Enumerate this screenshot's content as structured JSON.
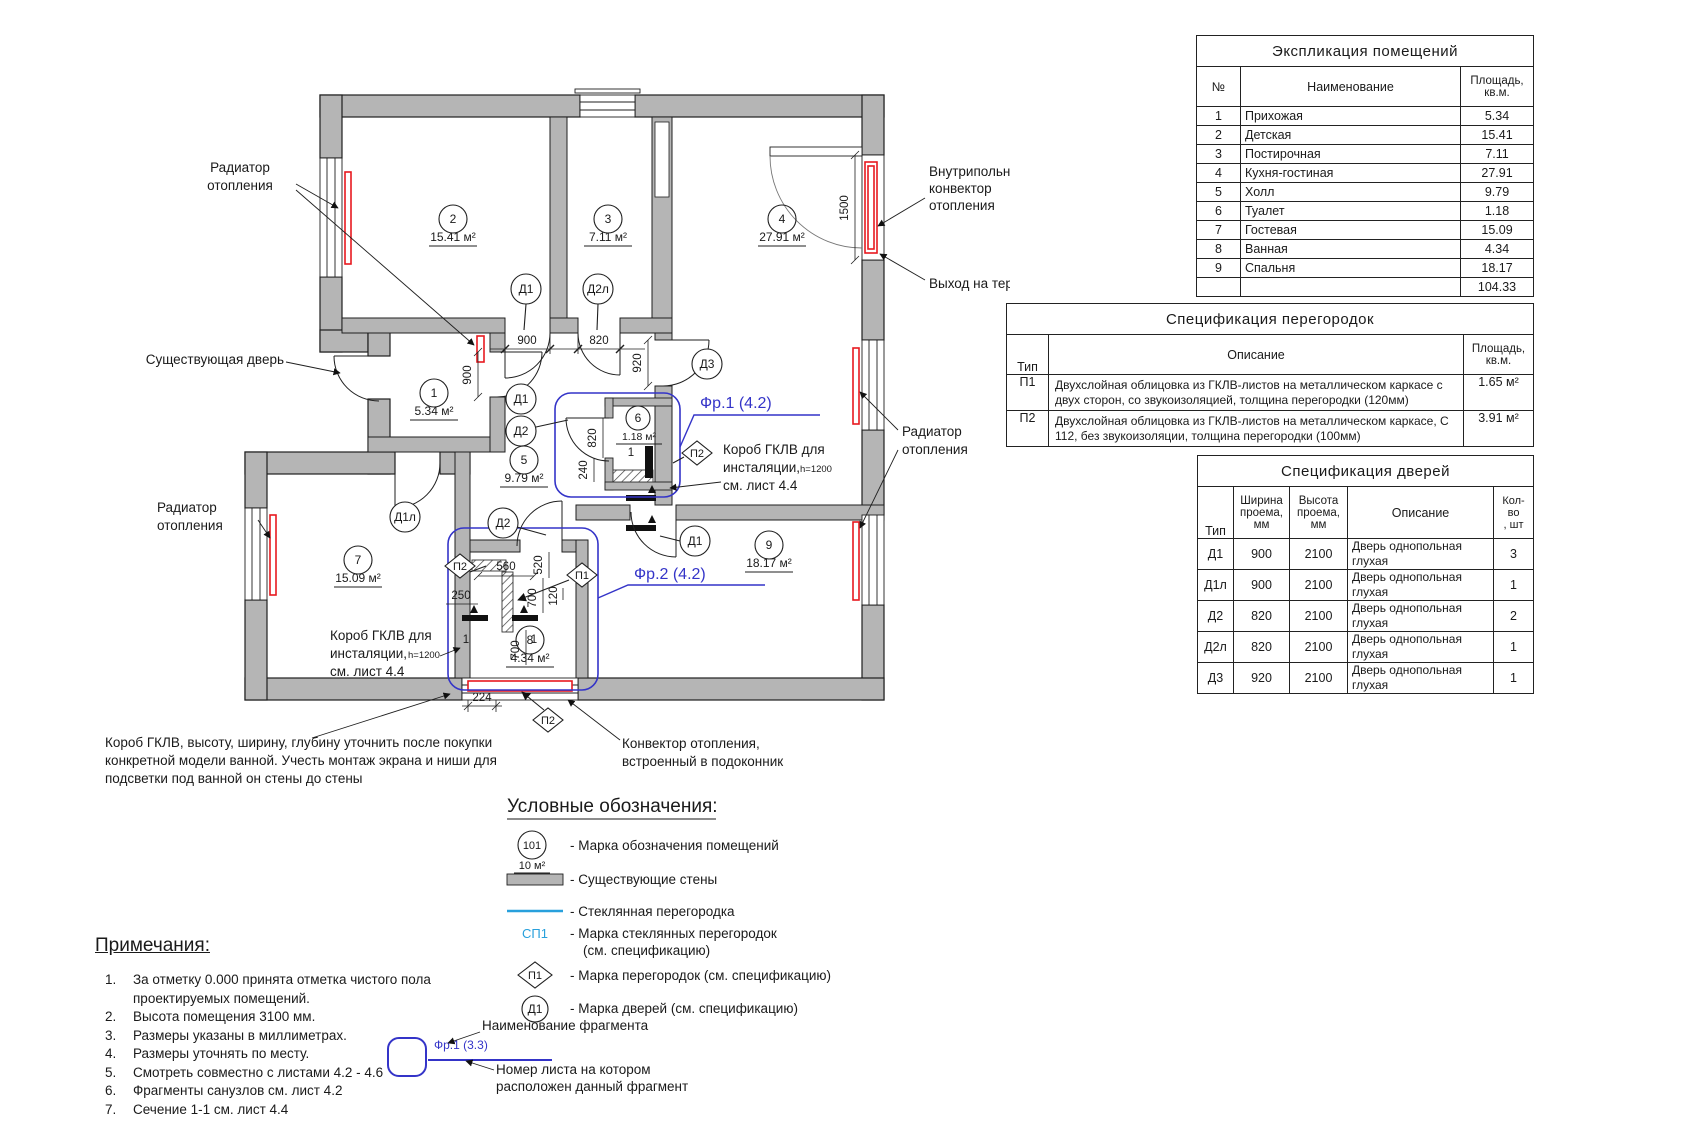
{
  "plan": {
    "labels": {
      "radiator_top": [
        "Радиатор",
        "отопления"
      ],
      "radiator_right": [
        "Радиатор",
        "отопления"
      ],
      "radiator_left": [
        "Радиатор",
        "отопления"
      ],
      "existing_door": "Существующая дверь",
      "infloor_convector": [
        "Внутрипольный",
        "конвектор",
        "отопления"
      ],
      "terrace_exit": "Выход на террасу",
      "korob_right": [
        "Короб ГКЛВ для",
        "инсталяции,",
        "см. лист 4.4"
      ],
      "korob_left": [
        "Короб ГКЛВ для",
        "инсталяции,",
        "см. лист 4.4"
      ],
      "korob_h": "h=1200",
      "bath_note": [
        "Короб ГКЛВ, высоту, ширину, глубину уточнить после покупки",
        "конкретной модели ванной. Учесть монтаж экрана и ниши для",
        "подсветки под ванной он стены до стены"
      ],
      "convector_note": [
        "Конвектор отопления,",
        "встроенный в подоконник"
      ],
      "fr1": "Фр.1 (4.2)",
      "fr2": "Фр.2 (4.2)"
    },
    "rooms": [
      {
        "n": "1",
        "a": "5.34 м²"
      },
      {
        "n": "2",
        "a": "15.41 м²"
      },
      {
        "n": "3",
        "a": "7.11 м²"
      },
      {
        "n": "4",
        "a": "27.91 м²"
      },
      {
        "n": "5",
        "a": "9.79 м²"
      },
      {
        "n": "6",
        "a": "1.18 м²"
      },
      {
        "n": "7",
        "a": "15.09 м²"
      },
      {
        "n": "8",
        "a": "4.34 м²"
      },
      {
        "n": "9",
        "a": "18.17 м²"
      }
    ],
    "marks": {
      "d1": "Д1",
      "d1l": "Д1л",
      "d2": "Д2",
      "d2l": "Д2л",
      "d3": "Д3",
      "p1": "П1",
      "p2": "П2"
    },
    "dims": {
      "top_900": "900",
      "top_820": "820",
      "d3_920": "920",
      "r1_900": "900",
      "wc_820": "820",
      "wc_240": "240",
      "terrace_1500": "1500",
      "b_560": "560",
      "b_520": "520",
      "b_250": "250",
      "b_700a": "700",
      "b_120": "120",
      "b_700b": "700",
      "b_224": "224",
      "sec_1": "1"
    }
  },
  "legend": {
    "title": "Условные обозначения:",
    "room_mark": {
      "sym": "101",
      "sub": "10 м²",
      "text": "- Марка обозначения помещений"
    },
    "walls": "- Существующие стены",
    "glass": "- Стеклянная перегородка",
    "sp1": {
      "sym": "СП1",
      "line1": "- Марка стеклянных перегородок",
      "line2": "(см. спецификацию)"
    },
    "p1": {
      "sym": "П1",
      "text": "- Марка перегородок (см. спецификацию)"
    },
    "d1": {
      "sym": "Д1",
      "text": "- Марка дверей (см. спецификацию)"
    },
    "fragment": {
      "label": "Фр.1 (3.3)",
      "callout1": "Наименование фрагмента",
      "callout2": [
        "Номер листа на котором",
        "расположен данный фрагмент"
      ]
    }
  },
  "notes": {
    "title": "Примечания:",
    "items": [
      "За отметку 0.000 принята отметка чистого пола проектируемых помещений.",
      "Высота помещения 3100 мм.",
      "Размеры указаны в миллиметрах.",
      "Размеры уточнять по месту.",
      "Смотреть совместно с листами 4.2 - 4.6",
      "Фрагменты санузлов см. лист 4.2",
      "Сечение 1-1 см. лист 4.4"
    ]
  },
  "tables": {
    "rooms": {
      "title": "Экспликация помещений",
      "col_n": "№",
      "col_name": "Наименование",
      "col_area": "Площадь,\nкв.м.",
      "rows": [
        {
          "n": "1",
          "name": "Прихожая",
          "area": "5.34"
        },
        {
          "n": "2",
          "name": "Детская",
          "area": "15.41"
        },
        {
          "n": "3",
          "name": "Постирочная",
          "area": "7.11"
        },
        {
          "n": "4",
          "name": "Кухня-гостиная",
          "area": "27.91"
        },
        {
          "n": "5",
          "name": "Холл",
          "area": "9.79"
        },
        {
          "n": "6",
          "name": "Туалет",
          "area": "1.18"
        },
        {
          "n": "7",
          "name": "Гостевая",
          "area": "15.09"
        },
        {
          "n": "8",
          "name": "Ванная",
          "area": "4.34"
        },
        {
          "n": "9",
          "name": "Спальня",
          "area": "18.17"
        }
      ],
      "total": "104.33"
    },
    "partitions": {
      "title": "Спецификация перегородок",
      "col_type": "Тип",
      "col_desc": "Описание",
      "col_area": "Площадь,\nкв.м.",
      "rows": [
        {
          "t": "П1",
          "d": "Двухслойная облицовка из ГКЛВ-листов на металлическом каркасе с двух сторон, со звукоизоляцией, толщина перегородки (120мм)",
          "a": "1.65 м²"
        },
        {
          "t": "П2",
          "d": "Двухслойная облицовка из ГКЛВ-листов на металлическом каркасе, С 112, без звукоизоляции, толщина перегородки (100мм)",
          "a": "3.91 м²"
        }
      ]
    },
    "doors": {
      "title": "Спецификация дверей",
      "col_type": "Тип",
      "col_w": "Ширина\nпроема,\nмм",
      "col_h": "Высота\nпроема,\nмм",
      "col_desc": "Описание",
      "col_qty": "Кол-во\n, шт",
      "rows": [
        {
          "t": "Д1",
          "w": "900",
          "h": "2100",
          "d": "Дверь однопольная глухая",
          "q": "3"
        },
        {
          "t": "Д1л",
          "w": "900",
          "h": "2100",
          "d": "Дверь однопольная глухая",
          "q": "1"
        },
        {
          "t": "Д2",
          "w": "820",
          "h": "2100",
          "d": "Дверь однопольная глухая",
          "q": "2"
        },
        {
          "t": "Д2л",
          "w": "820",
          "h": "2100",
          "d": "Дверь однопольная глухая",
          "q": "1"
        },
        {
          "t": "Д3",
          "w": "920",
          "h": "2100",
          "d": "Дверь однопольная глухая",
          "q": "1"
        }
      ]
    }
  },
  "colors": {
    "wall": "#b5b5b5",
    "radiator": "#e8191f",
    "fragment": "#3434c8",
    "glass": "#28a0dc"
  }
}
